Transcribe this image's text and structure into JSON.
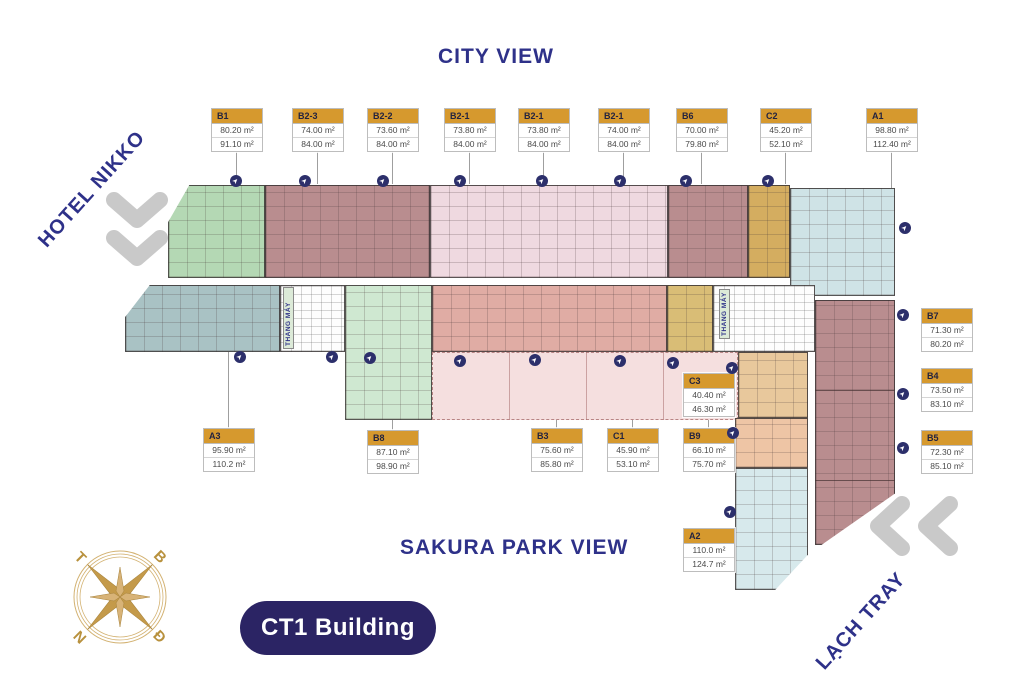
{
  "titles": {
    "city_view": "CITY VIEW",
    "sakura_park_view": "SAKURA PARK VIEW",
    "hotel_nikko": "HOTEL NIKKO",
    "lach_tray": "LẠCH TRAY",
    "building_badge": "CT1 Building"
  },
  "core_labels": {
    "elevator": "THANG MÁY"
  },
  "compass": {
    "b": "B",
    "d": "Đ",
    "n": "N",
    "t": "T"
  },
  "colors": {
    "navy_text": "#2e3189",
    "label_header": "#d6992e",
    "badge_bg": "#2b2464",
    "green": "#b4d8b4",
    "rose": "#b98d8f",
    "light_pink": "#efd9e0",
    "tan": "#d4ad60",
    "light_blue": "#cfe3e6",
    "blue_gray": "#a9c2c4",
    "light_green": "#cfe8d1",
    "salmon": "#e0aca4",
    "peach": "#eec5a5",
    "podium_pink": "#f3dcdc",
    "compass_gold": "#c49a4a",
    "chevron_gray": "#c9c9c9"
  },
  "units": [
    {
      "code": "B1",
      "area1": "80.20 m²",
      "area2": "91.10 m²"
    },
    {
      "code": "B2-3",
      "area1": "74.00 m²",
      "area2": "84.00 m²"
    },
    {
      "code": "B2-2",
      "area1": "73.60 m²",
      "area2": "84.00 m²"
    },
    {
      "code": "B2-1",
      "area1": "73.80 m²",
      "area2": "84.00 m²"
    },
    {
      "code": "B2-1",
      "area1": "73.80 m²",
      "area2": "84.00 m²"
    },
    {
      "code": "B2-1",
      "area1": "74.00 m²",
      "area2": "84.00 m²"
    },
    {
      "code": "B6",
      "area1": "70.00 m²",
      "area2": "79.80 m²"
    },
    {
      "code": "C2",
      "area1": "45.20 m²",
      "area2": "52.10 m²"
    },
    {
      "code": "A1",
      "area1": "98.80 m²",
      "area2": "112.40 m²"
    },
    {
      "code": "B7",
      "area1": "71.30 m²",
      "area2": "80.20 m²"
    },
    {
      "code": "B4",
      "area1": "73.50 m²",
      "area2": "83.10 m²"
    },
    {
      "code": "B5",
      "area1": "72.30 m²",
      "area2": "85.10 m²"
    },
    {
      "code": "A3",
      "area1": "95.90 m²",
      "area2": "110.2 m²"
    },
    {
      "code": "B8",
      "area1": "87.10 m²",
      "area2": "98.90 m²"
    },
    {
      "code": "B3",
      "area1": "75.60 m²",
      "area2": "85.80 m²"
    },
    {
      "code": "C1",
      "area1": "45.90 m²",
      "area2": "53.10 m²"
    },
    {
      "code": "B9",
      "area1": "66.10 m²",
      "area2": "75.70 m²"
    },
    {
      "code": "C3",
      "area1": "40.40 m²",
      "area2": "46.30 m²"
    },
    {
      "code": "A2",
      "area1": "110.0 m²",
      "area2": "124.7 m²"
    }
  ]
}
